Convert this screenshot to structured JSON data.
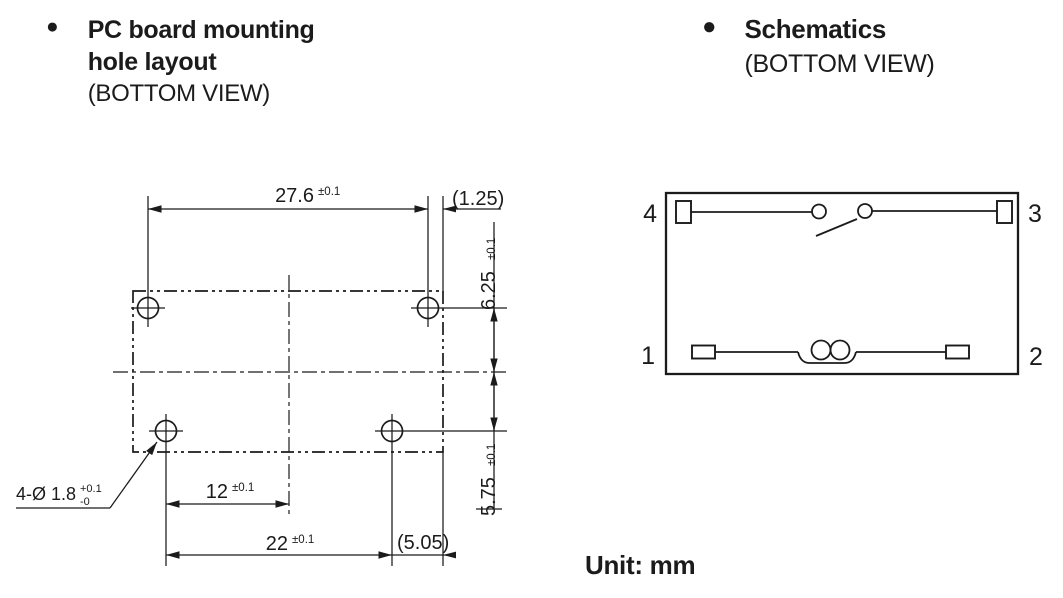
{
  "colors": {
    "ink": "#1b1b1b",
    "paper": "#ffffff"
  },
  "left_figure": {
    "bullet": "●",
    "title_line1": "PC board mounting",
    "title_line2": "hole layout",
    "view_label": "(BOTTOM VIEW)",
    "dims": {
      "top_pitch": {
        "value": "27.6",
        "tol": "±0.1"
      },
      "top_edge_offset": "(1.25)",
      "center_to_top_row": {
        "value": "6.25",
        "tol": "±0.1"
      },
      "center_to_bottom_row": {
        "value": "5.75",
        "tol": "±0.1"
      },
      "bottom_half_pitch": {
        "value": "12",
        "tol": "±0.1"
      },
      "bottom_pitch": {
        "value": "22",
        "tol": "±0.1"
      },
      "bottom_edge_offset": "(5.05)",
      "hole_callout": {
        "label": "4-Ø 1.8",
        "tol_plus": "+0.1",
        "tol_minus": "-0"
      }
    }
  },
  "right_figure": {
    "bullet": "●",
    "title": "Schematics",
    "view_label": "(BOTTOM VIEW)",
    "pin_labels": {
      "top_left": "4",
      "top_right": "3",
      "bottom_left": "1",
      "bottom_right": "2"
    }
  },
  "footer": {
    "unit_label": "Unit: mm"
  }
}
